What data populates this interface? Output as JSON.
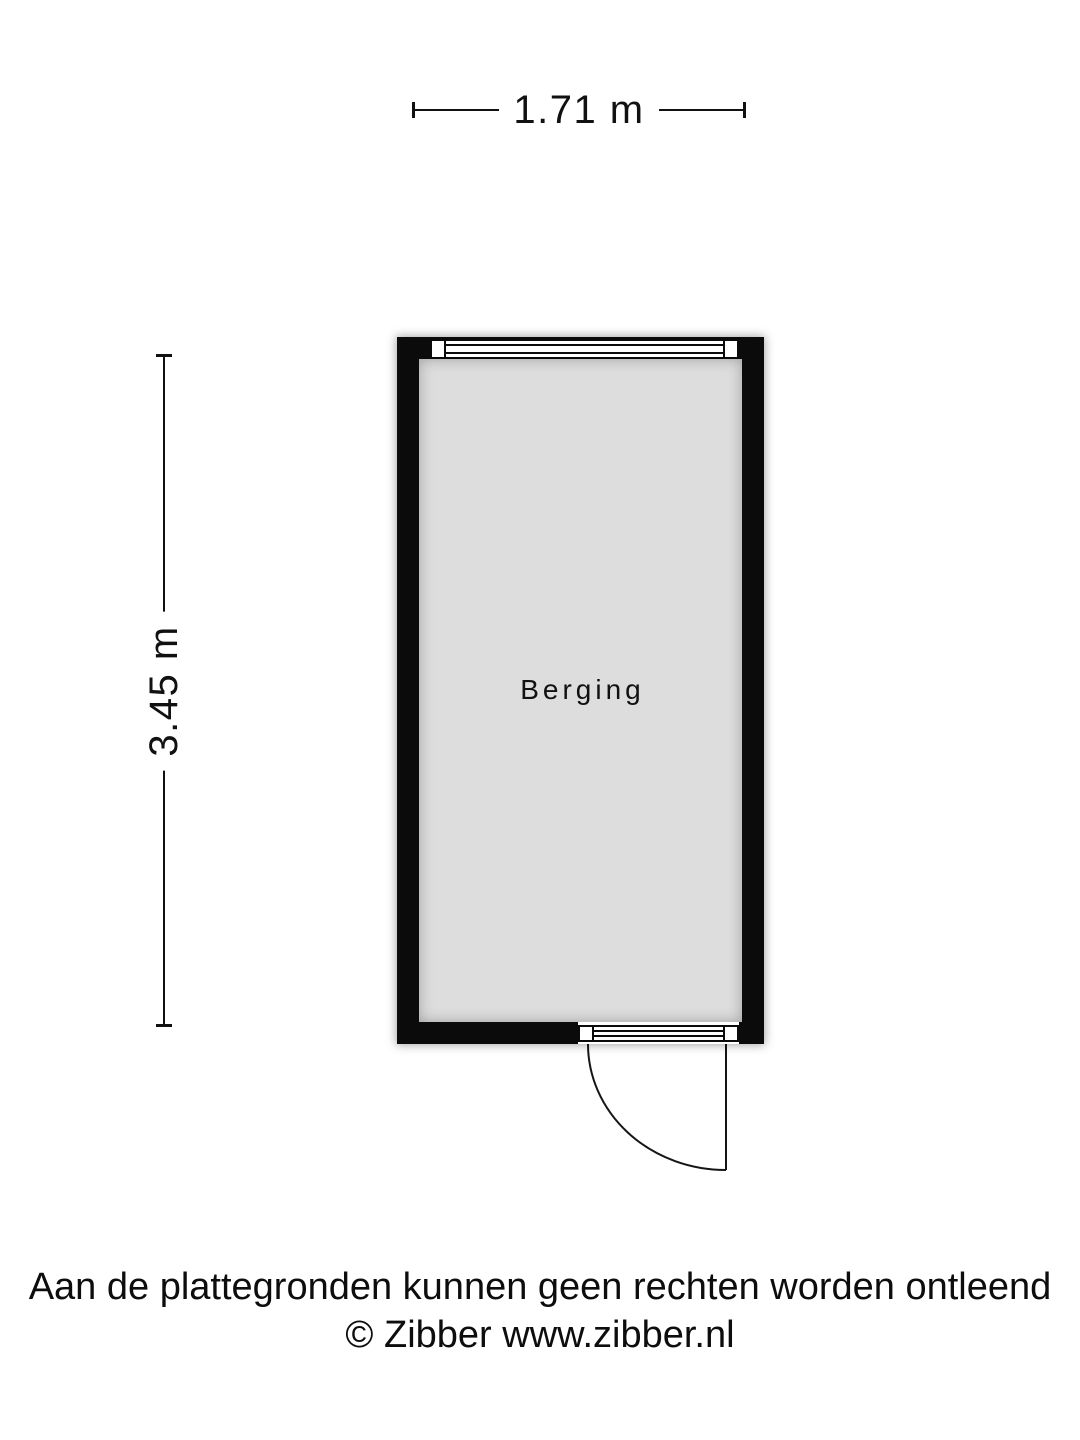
{
  "page": {
    "background": "#ffffff",
    "text_color": "#111111"
  },
  "dimensions": {
    "width_label": "1.71 m",
    "height_label": "3.45 m"
  },
  "room": {
    "name": "Berging",
    "wall_color": "#0b0b0b",
    "floor_color": "#dddddd"
  },
  "features": [
    {
      "type": "window",
      "wall": "top"
    },
    {
      "type": "door",
      "wall": "bottom",
      "hinge": "right",
      "swing": "outward"
    }
  ],
  "footer": {
    "disclaimer": "Aan de plattegronden kunnen geen rechten worden ontleend",
    "copyright": "© Zibber www.zibber.nl"
  }
}
